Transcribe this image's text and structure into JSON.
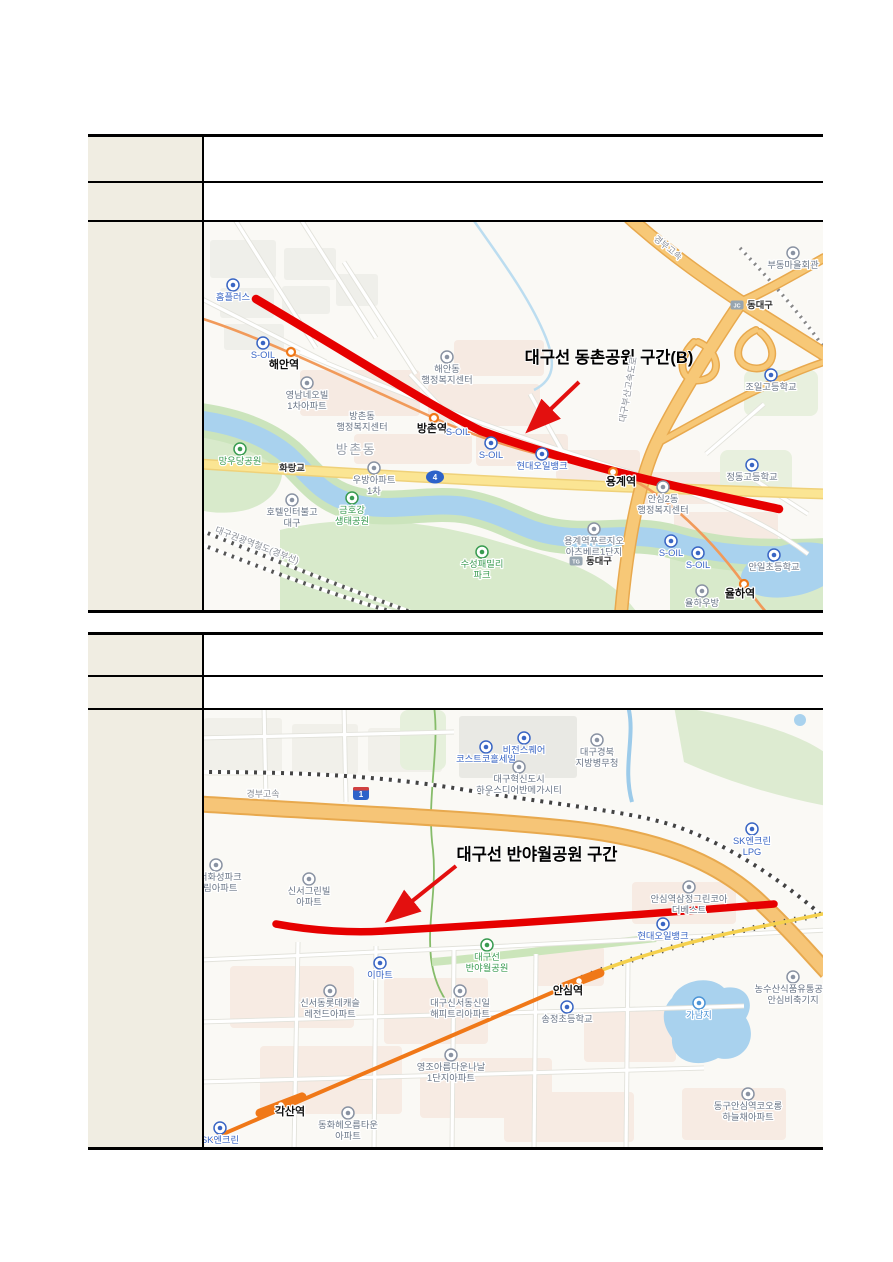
{
  "page": {
    "background": "#ffffff"
  },
  "tables": [
    {
      "rows": [
        {
          "label": "",
          "value": ""
        },
        {
          "label": "",
          "value": ""
        }
      ]
    },
    {
      "rows": [
        {
          "label": "",
          "value": ""
        },
        {
          "label": "",
          "value": ""
        }
      ]
    }
  ],
  "maps": [
    {
      "annotation": {
        "text": "대구선 동촌공원 구간(B)",
        "x": 405,
        "y": 141
      },
      "route": {
        "path": "M52,77 C150,135 230,186 277,209 C380,246 500,271 575,287",
        "color": "#E60000",
        "width": 8.5
      },
      "arrow": {
        "x1": 375,
        "y1": 160,
        "x2": 327,
        "y2": 206,
        "color": "#E3100F"
      },
      "rings": [
        {
          "x": 87,
          "y": 130
        },
        {
          "x": 230,
          "y": 196
        },
        {
          "x": 409,
          "y": 250
        },
        {
          "x": 540,
          "y": 362
        }
      ],
      "shields": [
        {
          "shape": "oval",
          "text": "4",
          "x": 231,
          "y": 255
        }
      ],
      "labels": [
        {
          "text": "홈플러스",
          "x": 29,
          "y": 78,
          "cls": "mart",
          "icon": true
        },
        {
          "text": "S-OIL",
          "x": 59,
          "y": 136,
          "cls": "mart",
          "icon": true
        },
        {
          "text": "해안역",
          "x": 80,
          "y": 146,
          "cls": "station"
        },
        {
          "text": "영남네오빌\n1차아파트",
          "x": 103,
          "y": 176,
          "cls": "poi",
          "icon": true
        },
        {
          "text": "해안동\n행정복지센터",
          "x": 243,
          "y": 150,
          "cls": "poi",
          "icon": true
        },
        {
          "text": "방촌동\n행정복지센터",
          "x": 158,
          "y": 197,
          "cls": "poi"
        },
        {
          "text": "방촌역",
          "x": 228,
          "y": 210,
          "cls": "station"
        },
        {
          "text": "S-OIL",
          "x": 254,
          "y": 213,
          "cls": "mart"
        },
        {
          "text": "S-OIL",
          "x": 287,
          "y": 236,
          "cls": "mart",
          "icon": true
        },
        {
          "text": "방촌동",
          "x": 152,
          "y": 232,
          "cls": "district"
        },
        {
          "text": "화랑교",
          "x": 88,
          "y": 249,
          "cls": "small"
        },
        {
          "text": "망우당공원",
          "x": 36,
          "y": 242,
          "cls": "park",
          "icon": true
        },
        {
          "text": "우방아파트\n1차",
          "x": 170,
          "y": 261,
          "cls": "poi",
          "icon": true
        },
        {
          "text": "호텔인터불고\n대구",
          "x": 88,
          "y": 293,
          "cls": "poi",
          "icon": true
        },
        {
          "text": "금호강\n생태공원",
          "x": 148,
          "y": 291,
          "cls": "park",
          "icon": true
        },
        {
          "text": "수성패밀리\n파크",
          "x": 278,
          "y": 345,
          "cls": "park",
          "icon": true
        },
        {
          "text": "현대오일뱅크",
          "x": 338,
          "y": 247,
          "cls": "mart",
          "icon": true
        },
        {
          "text": "용계역",
          "x": 417,
          "y": 263,
          "cls": "station"
        },
        {
          "text": "부동마을회관",
          "x": 589,
          "y": 46,
          "cls": "poi",
          "icon": true
        },
        {
          "text": "동대구",
          "x": 556,
          "y": 86,
          "cls": "small",
          "badge": "JC"
        },
        {
          "text": "조일고등학교",
          "x": 567,
          "y": 168,
          "cls": "school",
          "icon": true
        },
        {
          "text": "정동고등학교",
          "x": 548,
          "y": 258,
          "cls": "school",
          "icon": true
        },
        {
          "text": "안심2동\n행정복지센터",
          "x": 459,
          "y": 280,
          "cls": "poi",
          "icon": true
        },
        {
          "text": "용계역푸르지오\n아츠베르1단지",
          "x": 390,
          "y": 322,
          "cls": "poi",
          "icon": true
        },
        {
          "text": "동대구",
          "x": 395,
          "y": 342,
          "cls": "small",
          "badge": "TG"
        },
        {
          "text": "S-OIL",
          "x": 467,
          "y": 334,
          "cls": "mart",
          "icon": true
        },
        {
          "text": "S-OIL",
          "x": 494,
          "y": 346,
          "cls": "mart",
          "icon": true
        },
        {
          "text": "안일초등학교",
          "x": 570,
          "y": 348,
          "cls": "school",
          "icon": true
        },
        {
          "text": "율하역",
          "x": 536,
          "y": 375,
          "cls": "station"
        },
        {
          "text": "율하우방",
          "x": 498,
          "y": 384,
          "cls": "poi",
          "icon": true
        },
        {
          "text": "경부고속",
          "x": 462,
          "y": 28,
          "cls": "road",
          "rot": 38
        },
        {
          "text": "대구부산고속도로",
          "x": 427,
          "y": 168,
          "cls": "road",
          "rot": -80
        },
        {
          "text": "대구권광역철도(경부선)",
          "x": 52,
          "y": 326,
          "cls": "road",
          "rot": 21
        }
      ]
    },
    {
      "annotation": {
        "text": "대구선 반야월공원 구간",
        "x": 333,
        "y": 150
      },
      "route": {
        "path": "M72,214 C110,221 150,223 180,221 C320,213 460,203 570,194",
        "color": "#E60000",
        "width": 7.5
      },
      "arrow": {
        "x1": 252,
        "y1": 156,
        "x2": 187,
        "y2": 208,
        "color": "#E3100F"
      },
      "rings": [],
      "bars": [
        {
          "x": 375,
          "y": 271,
          "rot": -21
        },
        {
          "x": 77,
          "y": 395,
          "rot": -21
        }
      ],
      "shields": [
        {
          "shape": "hshield",
          "text": "1",
          "x": 157,
          "y": 84
        }
      ],
      "labels": [
        {
          "text": "경부고속",
          "x": 59,
          "y": 87,
          "cls": "road"
        },
        {
          "text": "코스트코홀세일",
          "x": 282,
          "y": 52,
          "cls": "mart",
          "icon": true
        },
        {
          "text": "비전스퀘어",
          "x": 320,
          "y": 43,
          "cls": "mart",
          "icon": true
        },
        {
          "text": "대구혁신도시\n하우스디어반메가시티",
          "x": 315,
          "y": 72,
          "cls": "poi",
          "icon": true
        },
        {
          "text": "대구경북\n지방병무청",
          "x": 393,
          "y": 45,
          "cls": "poi",
          "icon": true
        },
        {
          "text": "SK엔크린\nLPG",
          "x": 548,
          "y": 134,
          "cls": "mart",
          "icon": true
        },
        {
          "text": "신서화성파크\n드림아파트",
          "x": 12,
          "y": 170,
          "cls": "poi",
          "icon": true
        },
        {
          "text": "신서그린빌\n아파트",
          "x": 105,
          "y": 184,
          "cls": "poi",
          "icon": true
        },
        {
          "text": "안심역삼정그린코아\n더베스트",
          "x": 485,
          "y": 192,
          "cls": "poi",
          "icon": true
        },
        {
          "text": "현대오일뱅크",
          "x": 459,
          "y": 229,
          "cls": "mart",
          "icon": true
        },
        {
          "text": "대구선\n반야월공원",
          "x": 283,
          "y": 250,
          "cls": "park",
          "icon": true
        },
        {
          "text": "이마트",
          "x": 176,
          "y": 268,
          "cls": "mart",
          "icon": true
        },
        {
          "text": "신서동롯데캐슬\n레전드아파트",
          "x": 126,
          "y": 296,
          "cls": "poi",
          "icon": true
        },
        {
          "text": "대구신서동신일\n해피트리아파트",
          "x": 256,
          "y": 296,
          "cls": "poi",
          "icon": true
        },
        {
          "text": "안심역",
          "x": 364,
          "y": 284,
          "cls": "station"
        },
        {
          "text": "송정초등학교",
          "x": 363,
          "y": 312,
          "cls": "school",
          "icon": true
        },
        {
          "text": "가남지",
          "x": 495,
          "y": 308,
          "cls": "water",
          "icon": true
        },
        {
          "text": "농수산식품유통공사\n안심비축기지",
          "x": 589,
          "y": 282,
          "cls": "poi",
          "icon": true
        },
        {
          "text": "영조아름다운나날\n1단지아파트",
          "x": 247,
          "y": 360,
          "cls": "poi",
          "icon": true
        },
        {
          "text": "각산역",
          "x": 86,
          "y": 405,
          "cls": "station"
        },
        {
          "text": "동화헤오름타운\n아파트",
          "x": 144,
          "y": 418,
          "cls": "poi",
          "icon": true
        },
        {
          "text": "동구안심역코오롱\n하늘채아파트",
          "x": 544,
          "y": 399,
          "cls": "poi",
          "icon": true
        },
        {
          "text": "SK엔크린",
          "x": 16,
          "y": 433,
          "cls": "mart",
          "icon": true
        }
      ]
    }
  ]
}
